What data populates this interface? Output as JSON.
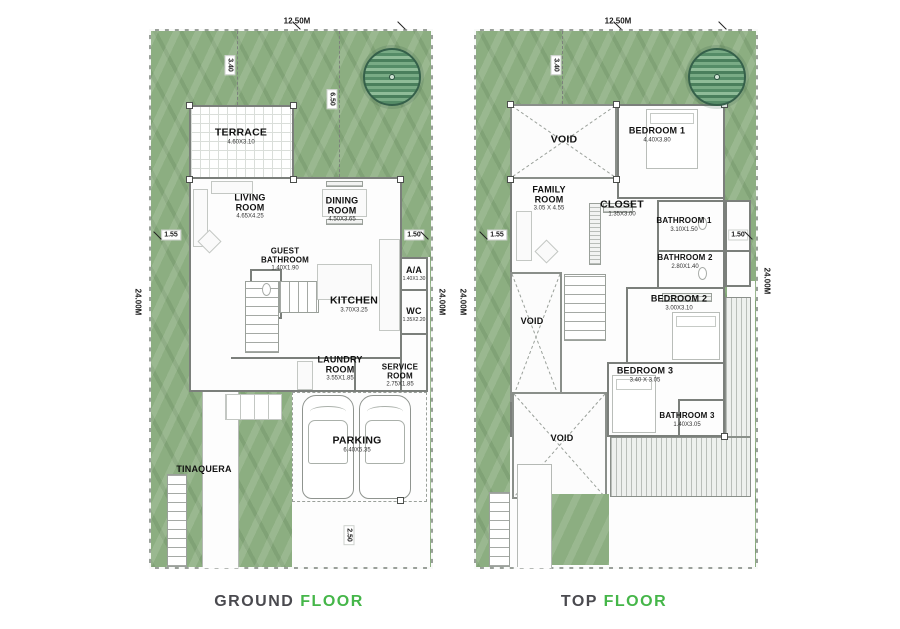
{
  "palette": {
    "lawn": "#8cae81",
    "boundary": "#9aa09a",
    "wall": "#7b7f7b",
    "caption_dark": "#4a4a4f",
    "caption_green": "#45b649"
  },
  "captions": {
    "ground": {
      "word1": "GROUND",
      "word2": "FLOOR"
    },
    "top": {
      "word1": "TOP",
      "word2": "FLOOR"
    }
  },
  "plans": [
    {
      "title": "ground-floor",
      "dims": {
        "width_top": "12.50M",
        "depth_left": "24.00M",
        "depth_right": "24.00M",
        "front_setback": "3.40",
        "terrace_depth": "6.50",
        "side_left": "1.55",
        "side_right": "1.50",
        "rear": "2.50"
      },
      "rooms": [
        {
          "name": "TERRACE",
          "size": "4.60X3.10"
        },
        {
          "name": "LIVING ROOM",
          "size": "4.65X4.25"
        },
        {
          "name": "DINING ROOM",
          "size": "4.50X3.65"
        },
        {
          "name": "GUEST BATHROOM",
          "size": "1.40X1.90"
        },
        {
          "name": "KITCHEN",
          "size": "3.70X3.25"
        },
        {
          "name": "A/A",
          "size": "1.40X1.30"
        },
        {
          "name": "WC",
          "size": "1.35X2.20"
        },
        {
          "name": "LAUNDRY ROOM",
          "size": "3.55X1.85"
        },
        {
          "name": "SERVICE ROOM",
          "size": "2.75X1.85"
        },
        {
          "name": "PARKING",
          "size": "6.40X5.35"
        },
        {
          "name": "TINAQUERA",
          "size": ""
        }
      ]
    },
    {
      "title": "top-floor",
      "dims": {
        "width_top": "12.50M",
        "depth_left": "24.00M",
        "depth_right": "24.00M",
        "front_setback": "3.40",
        "side_left": "1.55",
        "side_right": "1.50"
      },
      "rooms": [
        {
          "name": "VOID",
          "size": ""
        },
        {
          "name": "BEDROOM 1",
          "size": "4.40X3.80"
        },
        {
          "name": "FAMILY ROOM",
          "size": "3.05 X 4.55"
        },
        {
          "name": "CLOSET",
          "size": "1.35X3.00"
        },
        {
          "name": "BATHROOM 1",
          "size": "3.10X1.50"
        },
        {
          "name": "BATHROOM 2",
          "size": "2.80X1.40"
        },
        {
          "name": "BEDROOM 2",
          "size": "3.00X3.10"
        },
        {
          "name": "VOID",
          "size": ""
        },
        {
          "name": "BEDROOM 3",
          "size": "3.40 X 3.05"
        },
        {
          "name": "BATHROOM 3",
          "size": "1.40X3.05"
        },
        {
          "name": "VOID",
          "size": ""
        }
      ]
    }
  ]
}
